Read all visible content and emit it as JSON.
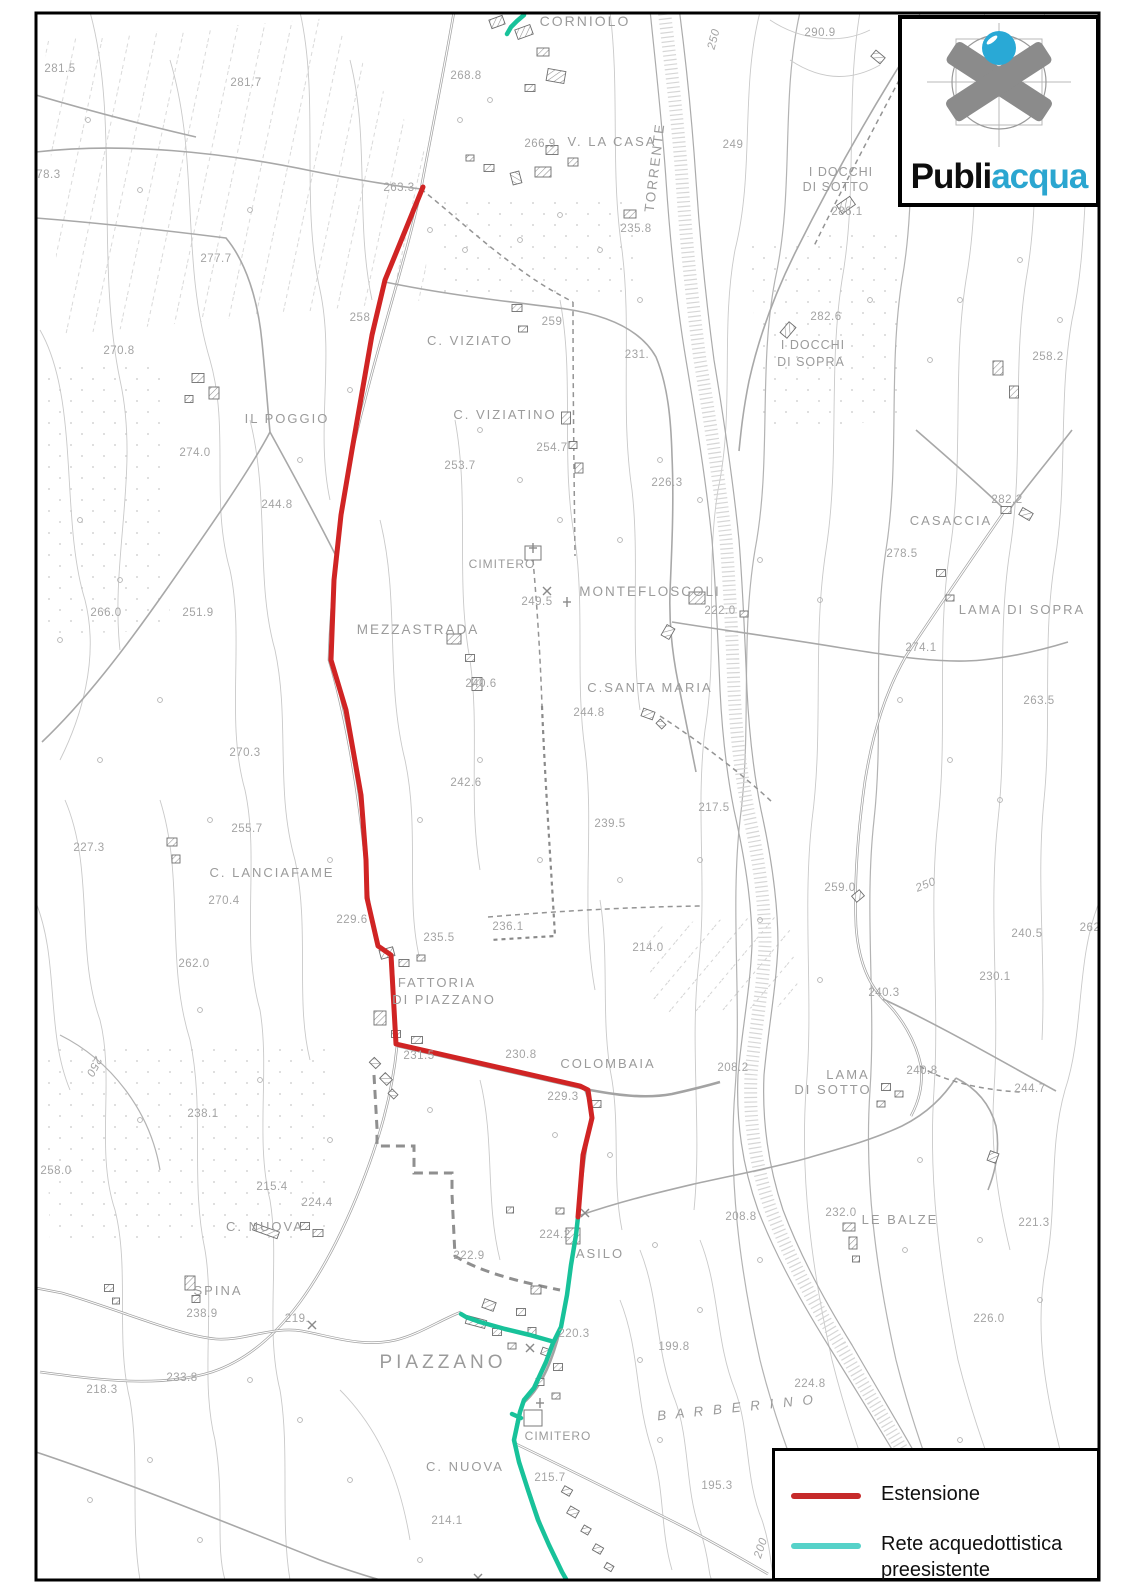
{
  "colors": {
    "estensione": "#d02424",
    "rete": "#18c29a",
    "rete_legend": "#56d2c9",
    "estensione_legend": "#c62a2a",
    "acqua_text": "#2ba6d0",
    "label": "#a4a4a4"
  },
  "logo": {
    "text_black": "Publi",
    "text_teal": "acqua"
  },
  "legend": {
    "items": [
      {
        "label": "Estensione",
        "color": "#c62a2a"
      },
      {
        "label": "Rete acquedottistica preesistente",
        "color": "#56d2c9"
      }
    ]
  },
  "map": {
    "red_line": {
      "name": "estensione-line",
      "points": [
        [
          423,
          187
        ],
        [
          385,
          280
        ],
        [
          372,
          335
        ],
        [
          352,
          450
        ],
        [
          341,
          515
        ],
        [
          334,
          580
        ],
        [
          331,
          660
        ],
        [
          346,
          710
        ],
        [
          361,
          795
        ],
        [
          366,
          860
        ],
        [
          367,
          898
        ],
        [
          378,
          946
        ],
        [
          391,
          955
        ],
        [
          396,
          1044
        ],
        [
          580,
          1086
        ],
        [
          588,
          1090
        ],
        [
          592,
          1118
        ],
        [
          583,
          1155
        ],
        [
          578,
          1217
        ]
      ]
    },
    "teal_lines": [
      {
        "name": "rete-main",
        "points": [
          [
            578,
            1217
          ],
          [
            576,
            1235
          ],
          [
            571,
            1265
          ],
          [
            567,
            1295
          ],
          [
            561,
            1327
          ],
          [
            553,
            1343
          ],
          [
            546,
            1362
          ],
          [
            534,
            1388
          ],
          [
            524,
            1400
          ],
          [
            520,
            1412
          ],
          [
            514,
            1440
          ],
          [
            519,
            1462
          ],
          [
            528,
            1490
          ],
          [
            538,
            1520
          ],
          [
            549,
            1545
          ],
          [
            562,
            1572
          ],
          [
            570,
            1586
          ]
        ]
      },
      {
        "name": "rete-branch",
        "points": [
          [
            551,
            1341
          ],
          [
            530,
            1335
          ],
          [
            505,
            1329
          ],
          [
            480,
            1322
          ],
          [
            466,
            1317
          ],
          [
            461,
            1314
          ]
        ]
      },
      {
        "name": "rete-north",
        "points": [
          [
            524,
            15
          ],
          [
            517,
            21
          ],
          [
            511,
            27
          ],
          [
            507,
            34
          ]
        ]
      },
      {
        "name": "rete-spur",
        "points": [
          [
            521,
            1418
          ],
          [
            512,
            1414
          ]
        ]
      }
    ],
    "labels": [
      {
        "t": "CORNIOLO",
        "x": 585,
        "y": 26,
        "k": "p",
        "s": 14,
        "sp": 2
      },
      {
        "t": "290.9",
        "x": 820,
        "y": 36
      },
      {
        "t": "281.5",
        "x": 60,
        "y": 72
      },
      {
        "t": "268.8",
        "x": 466,
        "y": 79
      },
      {
        "t": "281.7",
        "x": 246,
        "y": 86
      },
      {
        "t": "250",
        "x": 717,
        "y": 40,
        "r": -75,
        "s": 13,
        "it": 1
      },
      {
        "t": "266.9",
        "x": 540,
        "y": 147
      },
      {
        "t": "V. LA CASA",
        "x": 612,
        "y": 146,
        "k": "p",
        "s": 13,
        "sp": 2
      },
      {
        "t": "TORRENTE",
        "x": 659,
        "y": 168,
        "k": "p",
        "r": -83,
        "s": 13.5,
        "sp": 2
      },
      {
        "t": "249",
        "x": 733,
        "y": 148
      },
      {
        "t": "I DOCCHI",
        "x": 841,
        "y": 176,
        "k": "p",
        "s": 12.5,
        "sp": 1
      },
      {
        "t": "DI SOTTO",
        "x": 836,
        "y": 191,
        "k": "p",
        "s": 12.5,
        "sp": 1
      },
      {
        "t": "286.1",
        "x": 847,
        "y": 215
      },
      {
        "t": "278.3",
        "x": 45,
        "y": 178
      },
      {
        "t": "263.3",
        "x": 399,
        "y": 191
      },
      {
        "t": "235.8",
        "x": 636,
        "y": 232
      },
      {
        "t": "277.7",
        "x": 216,
        "y": 262
      },
      {
        "t": "258",
        "x": 360,
        "y": 321
      },
      {
        "t": "259",
        "x": 552,
        "y": 325
      },
      {
        "t": "282.6",
        "x": 826,
        "y": 320
      },
      {
        "t": "I DOCCHI",
        "x": 813,
        "y": 349,
        "k": "p",
        "s": 12.5,
        "sp": 1
      },
      {
        "t": "DI SOPRA",
        "x": 811,
        "y": 366,
        "k": "p",
        "s": 12.5,
        "sp": 1
      },
      {
        "t": "C. VIZIATO",
        "x": 470,
        "y": 345,
        "k": "p",
        "s": 13,
        "sp": 2
      },
      {
        "t": "231.",
        "x": 637,
        "y": 358
      },
      {
        "t": "270.8",
        "x": 119,
        "y": 354
      },
      {
        "t": "258.2",
        "x": 1048,
        "y": 360
      },
      {
        "t": "C. VIZIATINO",
        "x": 505,
        "y": 419,
        "k": "p",
        "s": 13,
        "sp": 2
      },
      {
        "t": "IL POGGIO",
        "x": 287,
        "y": 423,
        "k": "p",
        "s": 13,
        "sp": 2
      },
      {
        "t": "274.0",
        "x": 195,
        "y": 456
      },
      {
        "t": "254.7",
        "x": 552,
        "y": 451
      },
      {
        "t": "253.7",
        "x": 460,
        "y": 469
      },
      {
        "t": "226.3",
        "x": 667,
        "y": 486
      },
      {
        "t": "282.2",
        "x": 1007,
        "y": 503
      },
      {
        "t": "244.8",
        "x": 277,
        "y": 508
      },
      {
        "t": "CASACCIA",
        "x": 951,
        "y": 525,
        "k": "p",
        "s": 13,
        "sp": 2
      },
      {
        "t": "278.5",
        "x": 902,
        "y": 557
      },
      {
        "t": "CIMITERO",
        "x": 502,
        "y": 568,
        "k": "p",
        "s": 12,
        "sp": 1
      },
      {
        "t": "MONTEFLOSCOLI",
        "x": 650,
        "y": 596,
        "k": "p",
        "s": 13.5,
        "sp": 2
      },
      {
        "t": "249.5",
        "x": 537,
        "y": 605
      },
      {
        "t": "222.0",
        "x": 720,
        "y": 614
      },
      {
        "t": "LAMA DI SOPRA",
        "x": 1022,
        "y": 614,
        "k": "p",
        "s": 13,
        "sp": 2
      },
      {
        "t": "251.9",
        "x": 198,
        "y": 616
      },
      {
        "t": "266.0",
        "x": 106,
        "y": 616
      },
      {
        "t": "MEZZASTRADA",
        "x": 418,
        "y": 634,
        "k": "p",
        "s": 13.5,
        "sp": 2
      },
      {
        "t": "274.1",
        "x": 921,
        "y": 651
      },
      {
        "t": "240.6",
        "x": 481,
        "y": 687
      },
      {
        "t": "C.SANTA MARIA",
        "x": 650,
        "y": 692,
        "k": "p",
        "s": 13,
        "sp": 2
      },
      {
        "t": "263.5",
        "x": 1039,
        "y": 704
      },
      {
        "t": "244.8",
        "x": 589,
        "y": 716
      },
      {
        "t": "270.3",
        "x": 245,
        "y": 756
      },
      {
        "t": "242.6",
        "x": 466,
        "y": 786
      },
      {
        "t": "217.5",
        "x": 714,
        "y": 811
      },
      {
        "t": "239.5",
        "x": 610,
        "y": 827
      },
      {
        "t": "255.7",
        "x": 247,
        "y": 832
      },
      {
        "t": "227.3",
        "x": 89,
        "y": 851
      },
      {
        "t": "C. LANCIAFAME",
        "x": 272,
        "y": 877,
        "k": "p",
        "s": 13,
        "sp": 2
      },
      {
        "t": "250",
        "x": 927,
        "y": 888,
        "r": -22,
        "s": 15,
        "it": 1
      },
      {
        "t": "259.0",
        "x": 840,
        "y": 891
      },
      {
        "t": "270.4",
        "x": 224,
        "y": 904
      },
      {
        "t": "229.6",
        "x": 352,
        "y": 923
      },
      {
        "t": "236.1",
        "x": 508,
        "y": 930
      },
      {
        "t": "262",
        "x": 1090,
        "y": 931
      },
      {
        "t": "240.5",
        "x": 1027,
        "y": 937
      },
      {
        "t": "235.5",
        "x": 439,
        "y": 941
      },
      {
        "t": "214.0",
        "x": 648,
        "y": 951
      },
      {
        "t": "262.0",
        "x": 194,
        "y": 967
      },
      {
        "t": "230.1",
        "x": 995,
        "y": 980
      },
      {
        "t": "FATTORIA",
        "x": 437,
        "y": 987,
        "k": "p",
        "s": 13,
        "sp": 2
      },
      {
        "t": "240.3",
        "x": 884,
        "y": 996
      },
      {
        "t": "DI PIAZZANO",
        "x": 444,
        "y": 1004,
        "k": "p",
        "s": 13,
        "sp": 2
      },
      {
        "t": "231.5",
        "x": 419,
        "y": 1059
      },
      {
        "t": "230.8",
        "x": 521,
        "y": 1058
      },
      {
        "t": "COLOMBAIA",
        "x": 608,
        "y": 1068,
        "k": "p",
        "s": 13,
        "sp": 2
      },
      {
        "t": "250",
        "x": 91,
        "y": 1065,
        "r": 117,
        "s": 14,
        "it": 1
      },
      {
        "t": "208.2",
        "x": 733,
        "y": 1071
      },
      {
        "t": "240.8",
        "x": 922,
        "y": 1074
      },
      {
        "t": "LAMA",
        "x": 848,
        "y": 1079,
        "k": "p",
        "s": 13,
        "sp": 2
      },
      {
        "t": "244.7",
        "x": 1030,
        "y": 1092
      },
      {
        "t": "DI SOTTO",
        "x": 833,
        "y": 1094,
        "k": "p",
        "s": 13,
        "sp": 2
      },
      {
        "t": "229.3",
        "x": 563,
        "y": 1100
      },
      {
        "t": "238.1",
        "x": 203,
        "y": 1117
      },
      {
        "t": "258.0",
        "x": 56,
        "y": 1174
      },
      {
        "t": "215.4",
        "x": 272,
        "y": 1190
      },
      {
        "t": "224.4",
        "x": 317,
        "y": 1206
      },
      {
        "t": "232.0",
        "x": 841,
        "y": 1216
      },
      {
        "t": "LE BALZE",
        "x": 900,
        "y": 1224,
        "k": "p",
        "s": 13,
        "sp": 2
      },
      {
        "t": "208.8",
        "x": 741,
        "y": 1220
      },
      {
        "t": "221.3",
        "x": 1034,
        "y": 1226
      },
      {
        "t": "C. NUOVA",
        "x": 265,
        "y": 1231,
        "k": "p",
        "s": 13,
        "sp": 2
      },
      {
        "t": "224.2",
        "x": 555,
        "y": 1238
      },
      {
        "t": "ASILO",
        "x": 600,
        "y": 1258,
        "k": "p",
        "s": 13,
        "sp": 2
      },
      {
        "t": "222.9",
        "x": 469,
        "y": 1259
      },
      {
        "t": "SPINA",
        "x": 218,
        "y": 1295,
        "k": "p",
        "s": 13,
        "sp": 2
      },
      {
        "t": "238.9",
        "x": 202,
        "y": 1317
      },
      {
        "t": "219.",
        "x": 297,
        "y": 1322
      },
      {
        "t": "226.0",
        "x": 989,
        "y": 1322
      },
      {
        "t": "220.3",
        "x": 574,
        "y": 1337
      },
      {
        "t": "199.8",
        "x": 674,
        "y": 1350
      },
      {
        "t": "PIAZZANO",
        "x": 443,
        "y": 1368,
        "k": "p",
        "s": 19,
        "sp": 4
      },
      {
        "t": "233.8",
        "x": 182,
        "y": 1381
      },
      {
        "t": "224.8",
        "x": 810,
        "y": 1387
      },
      {
        "t": "B A R B E R I N O",
        "x": 737,
        "y": 1412,
        "k": "p",
        "s": 13.5,
        "sp": 3,
        "it": 1,
        "r": -6
      },
      {
        "t": "218.3",
        "x": 102,
        "y": 1393
      },
      {
        "t": "CIMITERO",
        "x": 558,
        "y": 1440,
        "k": "p",
        "s": 12,
        "sp": 1
      },
      {
        "t": "C. NUOVA",
        "x": 465,
        "y": 1471,
        "k": "p",
        "s": 13,
        "sp": 2
      },
      {
        "t": "215.7",
        "x": 550,
        "y": 1481
      },
      {
        "t": "195.3",
        "x": 717,
        "y": 1489
      },
      {
        "t": "214.1",
        "x": 447,
        "y": 1524
      },
      {
        "t": "200",
        "x": 764,
        "y": 1549,
        "r": -72,
        "s": 13,
        "it": 1
      }
    ]
  }
}
